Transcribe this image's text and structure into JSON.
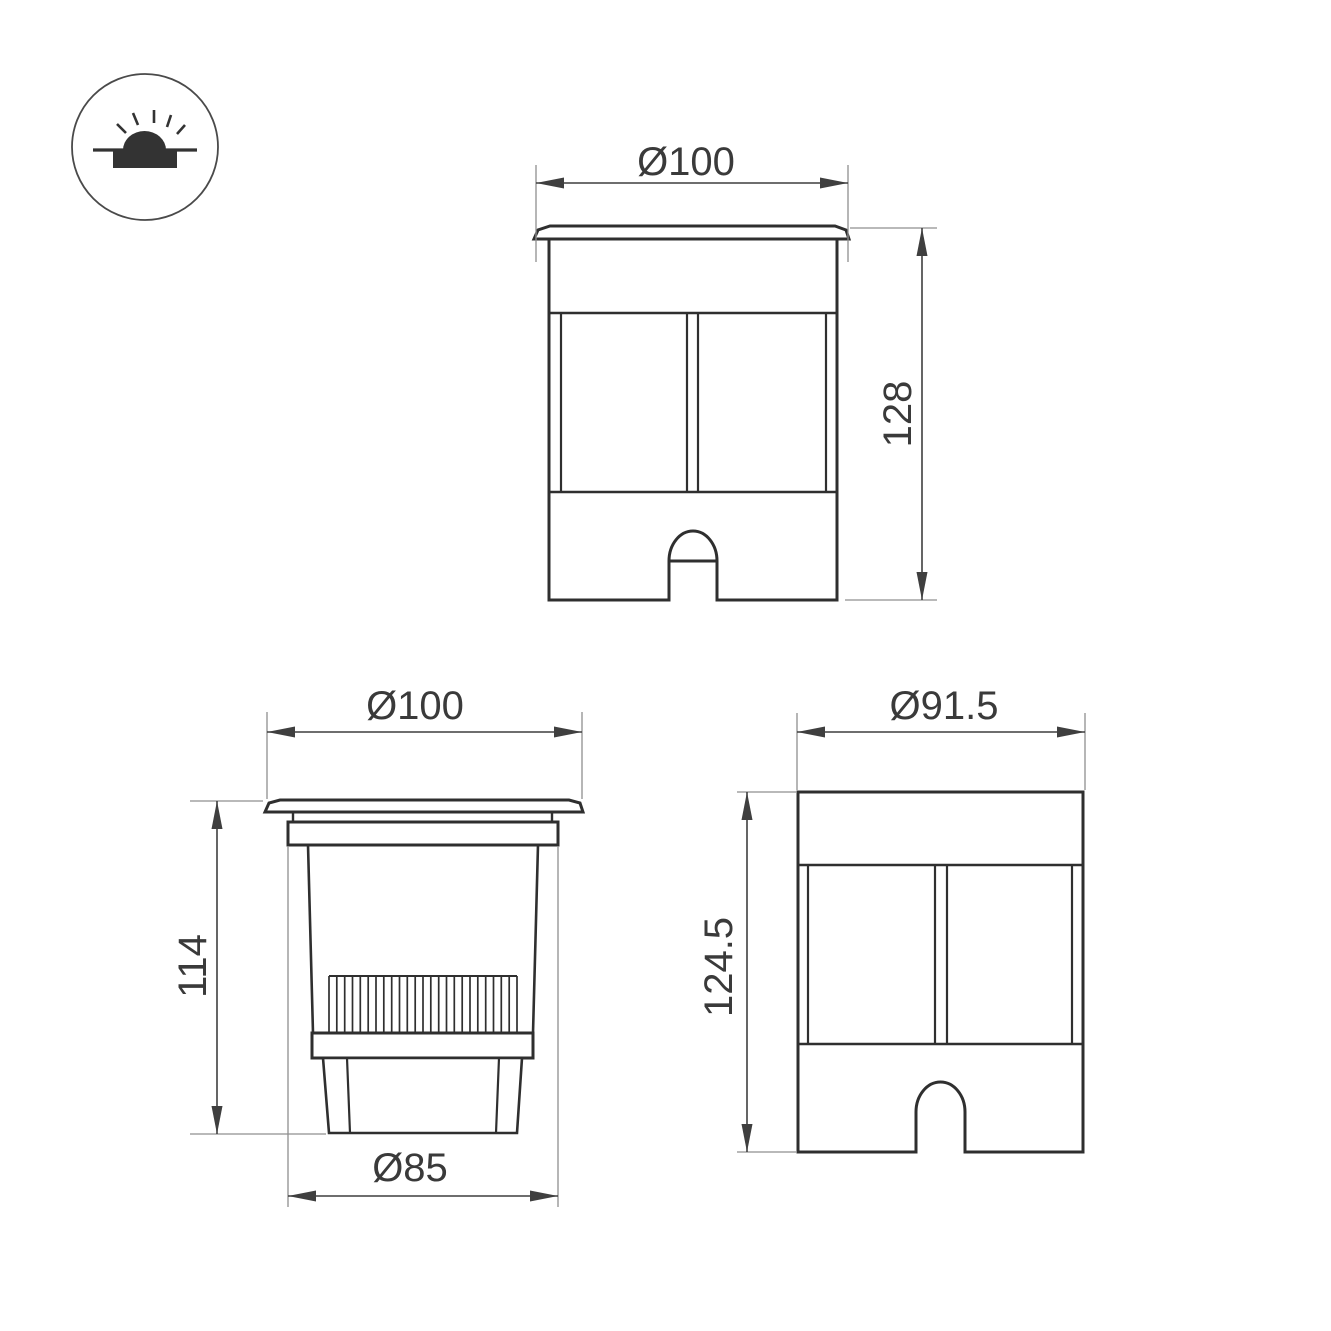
{
  "colors": {
    "background": "#ffffff",
    "outline": "#2f2f2f",
    "dimension_line": "#3f3f3f",
    "extension_line": "#8f8f8f",
    "label_text": "#3a3a3a",
    "icon_fill": "#333333"
  },
  "icon": {
    "name": "recessed-ground-light-symbol"
  },
  "views": {
    "front": {
      "label_width": "Ø100",
      "label_height": "128"
    },
    "section": {
      "label_width": "Ø100",
      "label_height": "114",
      "label_bottom_width": "Ø85"
    },
    "side": {
      "label_width": "Ø91.5",
      "label_height": "124.5"
    }
  }
}
